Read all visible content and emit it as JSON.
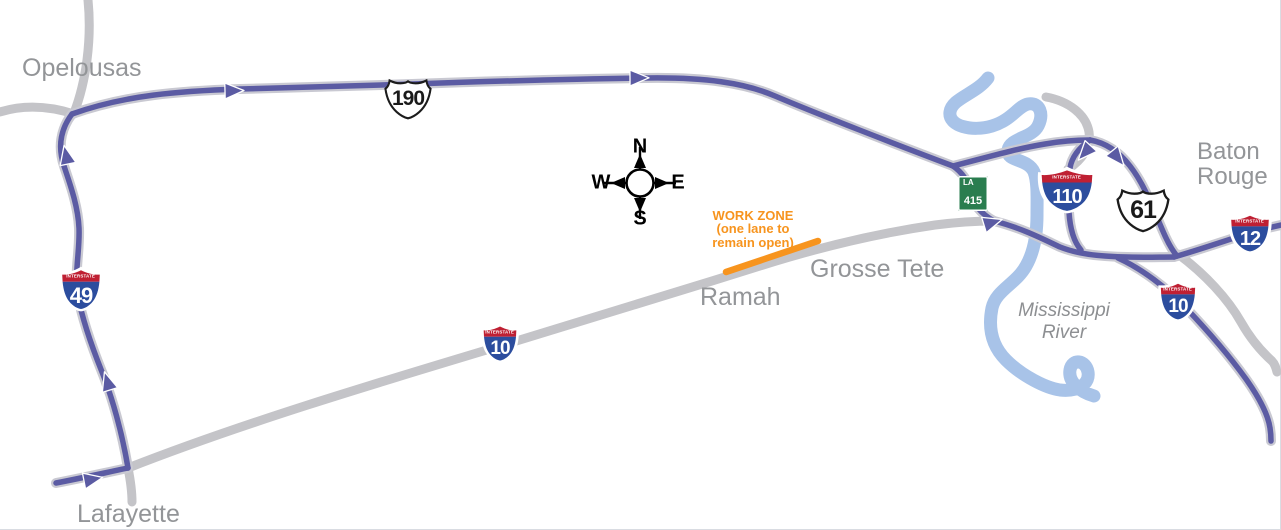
{
  "colors": {
    "detour_route_purple": "#5b5ba3",
    "road_gray": "#c4c4c8",
    "road_casing_gray": "#c9c9d2",
    "river_blue": "#a8c3e8",
    "work_zone_orange": "#f7941e",
    "interstate_red": "#bf2033",
    "interstate_blue": "#2c4d9e",
    "la_shield_green": "#2a7d4f",
    "label_gray": "#939598"
  },
  "cities": {
    "opelousas": "Opelousas",
    "lafayette": "Lafayette",
    "baton_rouge": "Baton Rouge"
  },
  "towns": {
    "ramah": "Ramah",
    "grosse_tete": "Grosse Tete"
  },
  "river": {
    "name": "Mississippi River"
  },
  "work_zone": {
    "title": "WORK ZONE",
    "detail": "(one lane to remain open)"
  },
  "compass": {
    "north": "N",
    "south": "S",
    "east": "E",
    "west": "W"
  },
  "shields": {
    "i49": {
      "banner": "INTERSTATE",
      "number": "49"
    },
    "i10_central": {
      "banner": "INTERSTATE",
      "number": "10"
    },
    "i10_east": {
      "banner": "INTERSTATE",
      "number": "10"
    },
    "i110": {
      "banner": "INTERSTATE",
      "number": "110"
    },
    "i12": {
      "banner": "INTERSTATE",
      "number": "12"
    },
    "us190": {
      "number": "190"
    },
    "us61": {
      "number": "61"
    },
    "la415": {
      "state": "LA",
      "number": "415"
    }
  }
}
